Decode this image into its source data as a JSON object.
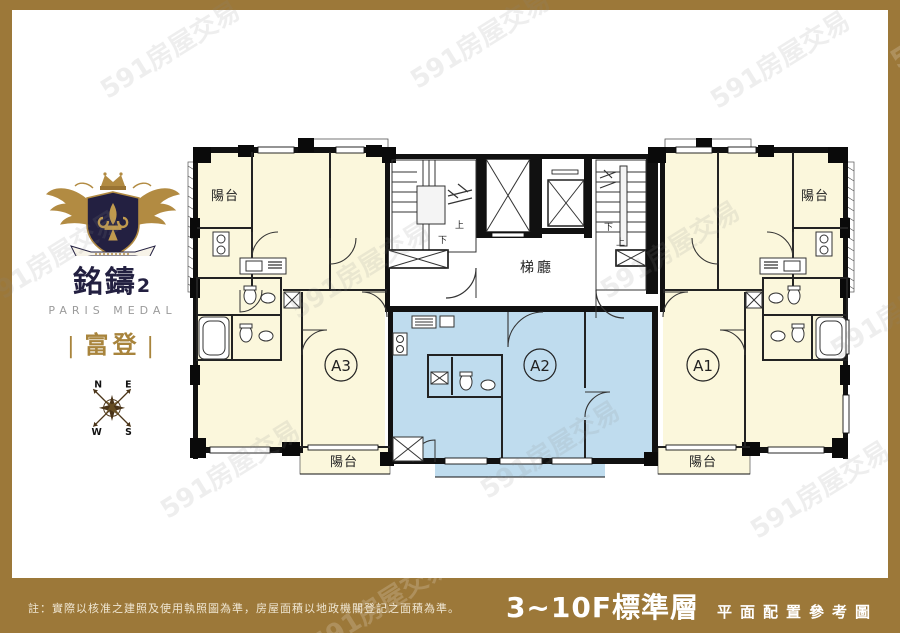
{
  "page": {
    "frame_color": "#9C7839",
    "canvas_color": "#ffffff"
  },
  "brand": {
    "crest_icon": "winged-crest-fleur-de-lis",
    "name_zh": "銘鑄",
    "name_num": "2",
    "name_en": "PARIS MEDAL",
    "sub_bar_left": "|",
    "subtitle": "富登",
    "sub_bar_right": "|",
    "colors": {
      "navy": "#232041",
      "gold": "#B28B42",
      "gray": "#9b9b9b"
    }
  },
  "compass": {
    "n": "N",
    "e": "E",
    "w": "W",
    "s": "S"
  },
  "floor_plan": {
    "units": [
      {
        "id": "A3",
        "highlight": false
      },
      {
        "id": "A2",
        "highlight": true
      },
      {
        "id": "A1",
        "highlight": false
      }
    ],
    "labels": {
      "lobby": "梯廳",
      "balcony": "陽台",
      "stair_up": "上",
      "stair_down": "下"
    },
    "colors": {
      "room": "#FBF7DC",
      "highlight": "#BFDCEE",
      "wall": "#111111"
    }
  },
  "footer": {
    "note": "註：實際以核准之建照及使用執照圖為準，房屋面積以地政機關登記之面積為準。",
    "floor_title": "3~10F標準層",
    "subtitle": "平面配置參考圖"
  },
  "watermark": {
    "text": "591房屋交易"
  }
}
